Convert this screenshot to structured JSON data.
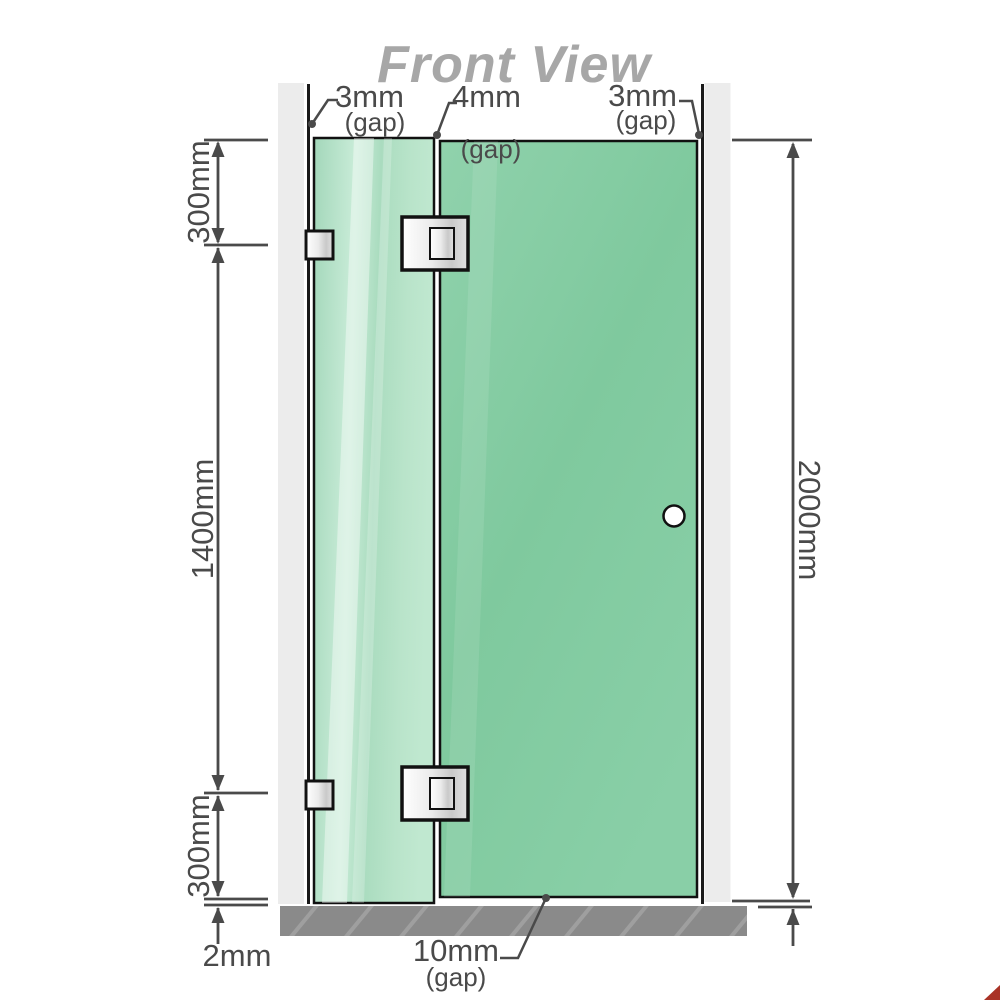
{
  "title": "Front View",
  "diagram": {
    "top_gaps": {
      "left": {
        "value": "3mm",
        "label": "(gap)"
      },
      "middle": {
        "value": "4mm",
        "label": "(gap)"
      },
      "right": {
        "value": "3mm",
        "label": "(gap)"
      }
    },
    "left_dimensions": {
      "top_section": "300mm",
      "middle_section": "1400mm",
      "bottom_section": "300mm",
      "floor_gap": "2mm"
    },
    "right_dimension": {
      "total_height": "2000mm"
    },
    "bottom_gap": {
      "value": "10mm",
      "label": "(gap)"
    },
    "parts": {
      "fixed_panel": "fixed-glass-panel",
      "door_panel": "door-glass-panel",
      "handle": "door-handle-knob",
      "hinges": "glass-to-glass-hinges",
      "brackets": "wall-to-glass-brackets",
      "floor": "floor-base"
    }
  },
  "colors": {
    "line": "#4a4a4a",
    "title": "#a7a7a7",
    "wall_post": "#ececec",
    "wall_line": "#1a1a1a",
    "floor": "#8a8a8a",
    "glass_fixed": "#aeddc2",
    "glass_door": "#82cba2",
    "hinge_metal": "#e8e8e8",
    "handle_fill": "#ffffff",
    "corner_mark": "#a93226"
  }
}
